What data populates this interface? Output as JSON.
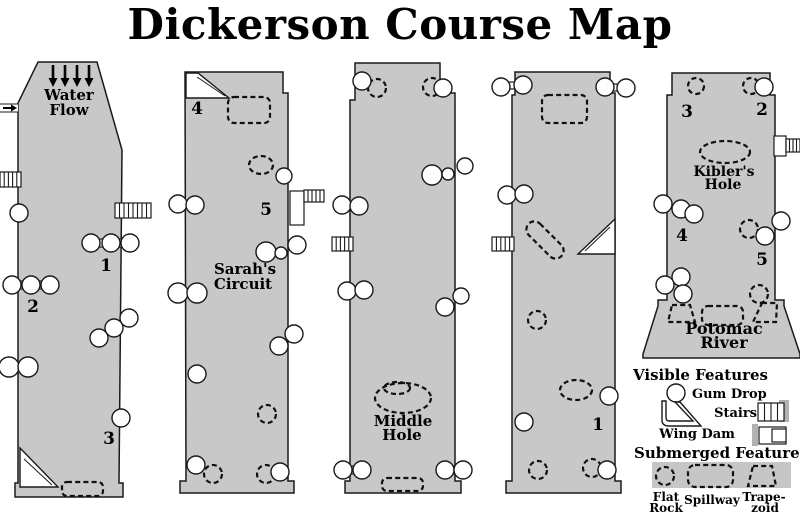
{
  "title": "Dickerson Course Map",
  "colors": {
    "channel_fill": "#c8c8c8",
    "outline": "#1a1a1a",
    "background": "#ffffff",
    "legend_strip": "#c6c6c6",
    "stair_shadow": "#b2b2b2"
  },
  "channels": [
    {
      "id": "channel-1",
      "outline": "38,62 97,62 122,150 119,483 123,483 123,497 15,497 15,483 18,483 18,103",
      "water_flow_arrows": [
        53,
        65,
        77,
        89
      ],
      "inlet": true,
      "gumdrops": [
        [
          19,
          213,
          9
        ],
        [
          91,
          243,
          9
        ],
        [
          111,
          243,
          9
        ],
        [
          130,
          243,
          9
        ],
        [
          12,
          285,
          9
        ],
        [
          31,
          285,
          9
        ],
        [
          50,
          285,
          9
        ],
        [
          9,
          367,
          10
        ],
        [
          28,
          367,
          10
        ],
        [
          129,
          318,
          9
        ],
        [
          114,
          328,
          9
        ],
        [
          99,
          338,
          9
        ],
        [
          121,
          418,
          9
        ]
      ],
      "links": [
        [
          97,
          239,
          8,
          8
        ],
        [
          117,
          239,
          8,
          8
        ],
        [
          19,
          281,
          7,
          8
        ],
        [
          38,
          281,
          7,
          8
        ]
      ],
      "dashed_circles": [],
      "dashed_ellipses": [],
      "dashed_rects": [
        [
          62,
          482,
          41,
          14,
          5,
          0
        ]
      ],
      "dashed_polys": [],
      "wing_dams": [
        {
          "pts": "20,448 58,487 20,487",
          "inner": "24,459 52,485"
        }
      ],
      "stairs": [
        [
          0,
          172,
          21,
          15,
          4
        ],
        [
          115,
          203,
          36,
          15,
          7
        ]
      ],
      "platforms": [],
      "labels": [
        [
          "Water",
          69,
          100,
          15
        ],
        [
          "Flow",
          69,
          115,
          15
        ],
        [
          "1",
          106,
          271,
          17
        ],
        [
          "2",
          33,
          312,
          17
        ],
        [
          "3",
          109,
          444,
          17
        ]
      ]
    },
    {
      "id": "channel-2",
      "outline": "185,72 283,72 283,93 288,93 288,481 294,481 294,493 180,493 180,481 186,481",
      "gumdrops": [
        [
          178,
          204,
          9
        ],
        [
          195,
          205,
          9
        ],
        [
          284,
          176,
          8
        ],
        [
          297,
          245,
          9
        ],
        [
          266,
          252,
          10
        ],
        [
          281,
          253,
          6
        ],
        [
          178,
          293,
          10
        ],
        [
          197,
          293,
          10
        ],
        [
          294,
          334,
          9
        ],
        [
          279,
          346,
          9
        ],
        [
          197,
          374,
          9
        ],
        [
          196,
          465,
          9
        ],
        [
          280,
          472,
          9
        ]
      ],
      "links": [],
      "dashed_circles": [
        [
          267,
          414,
          9
        ],
        [
          213,
          474,
          9
        ],
        [
          266,
          474,
          9
        ]
      ],
      "dashed_ellipses": [
        [
          261,
          165,
          12,
          9,
          0
        ]
      ],
      "dashed_rects": [
        [
          228,
          97,
          42,
          26,
          6,
          0
        ]
      ],
      "dashed_polys": [],
      "wing_dams": [
        {
          "pts": "186,73 198,73 229,98 186,98",
          "inner": "197,77 225,96"
        }
      ],
      "stairs": [
        [
          304,
          190,
          20,
          12,
          4
        ]
      ],
      "platforms": [
        [
          290,
          191,
          14,
          34
        ]
      ],
      "labels": [
        [
          "4",
          197,
          114,
          17
        ],
        [
          "5",
          266,
          215,
          17
        ],
        [
          "Sarah's",
          245,
          274,
          15
        ],
        [
          "Circuit",
          243,
          289,
          15
        ]
      ]
    },
    {
      "id": "channel-3",
      "outline": "355,63 440,63 440,93 455,93 455,481 461,481 461,493 345,493 345,481 350,481 350,100 355,100",
      "gumdrops": [
        [
          362,
          81,
          9
        ],
        [
          443,
          88,
          9
        ],
        [
          342,
          205,
          9
        ],
        [
          359,
          206,
          9
        ],
        [
          432,
          175,
          10
        ],
        [
          448,
          174,
          6
        ],
        [
          465,
          166,
          8
        ],
        [
          347,
          291,
          9
        ],
        [
          364,
          290,
          9
        ],
        [
          445,
          307,
          9
        ],
        [
          461,
          296,
          8
        ],
        [
          343,
          470,
          9
        ],
        [
          362,
          470,
          9
        ],
        [
          445,
          470,
          9
        ],
        [
          463,
          470,
          9
        ]
      ],
      "links": [
        [
          349,
          466,
          7,
          8
        ],
        [
          452,
          466,
          7,
          8
        ]
      ],
      "dashed_circles": [
        [
          377,
          88,
          9
        ],
        [
          432,
          87,
          9
        ]
      ],
      "dashed_ellipses": [
        [
          403,
          398,
          28,
          15,
          0
        ],
        [
          397,
          388,
          13,
          6,
          0
        ]
      ],
      "dashed_rects": [
        [
          382,
          478,
          41,
          13,
          5,
          0
        ]
      ],
      "dashed_polys": [],
      "wing_dams": [],
      "stairs": [
        [
          332,
          237,
          21,
          14,
          4
        ]
      ],
      "platforms": [],
      "labels": [
        [
          "Middle",
          403,
          426,
          15
        ],
        [
          "Hole",
          402,
          440,
          15
        ]
      ]
    },
    {
      "id": "channel-4",
      "outline": "515,72 610,72 610,93 615,93 615,481 621,481 621,493 506,493 506,481 512,481 512,95 515,95",
      "gumdrops": [
        [
          501,
          87,
          9
        ],
        [
          523,
          85,
          9
        ],
        [
          605,
          87,
          9
        ],
        [
          626,
          88,
          9
        ],
        [
          507,
          195,
          9
        ],
        [
          524,
          194,
          9
        ],
        [
          609,
          396,
          9
        ],
        [
          524,
          422,
          9
        ],
        [
          607,
          470,
          9
        ]
      ],
      "links": [
        [
          506,
          82,
          10,
          7
        ],
        [
          611,
          84,
          9,
          7
        ]
      ],
      "dashed_circles": [
        [
          537,
          320,
          9
        ],
        [
          538,
          470,
          9
        ],
        [
          592,
          468,
          9
        ]
      ],
      "dashed_ellipses": [
        [
          576,
          390,
          16,
          10,
          0
        ]
      ],
      "dashed_rects": [
        [
          542,
          95,
          45,
          28,
          6,
          0
        ],
        [
          522,
          232,
          46,
          16,
          8,
          45
        ]
      ],
      "dashed_polys": [],
      "wing_dams": [
        {
          "pts": "615,219 615,254 578,254",
          "inner": "610,227 585,251"
        }
      ],
      "stairs": [
        [
          492,
          237,
          22,
          14,
          4
        ]
      ],
      "platforms": [],
      "labels": [
        [
          "1",
          598,
          430,
          17
        ]
      ]
    },
    {
      "id": "channel-5",
      "outline": "672,73 770,73 770,95 775,95 775,300 784,300 784,306 800,354 800,358 643,358 643,354 658,306 658,300 667,300 667,95 672,95",
      "gumdrops": [
        [
          764,
          87,
          9
        ],
        [
          663,
          204,
          9
        ],
        [
          681,
          209,
          9
        ],
        [
          694,
          214,
          9
        ],
        [
          781,
          221,
          9
        ],
        [
          765,
          236,
          9
        ],
        [
          681,
          277,
          9
        ],
        [
          665,
          285,
          9
        ],
        [
          683,
          294,
          9
        ]
      ],
      "links": [],
      "dashed_circles": [
        [
          696,
          86,
          8
        ],
        [
          751,
          86,
          8
        ],
        [
          749,
          229,
          9
        ],
        [
          759,
          294,
          9
        ]
      ],
      "dashed_ellipses": [
        [
          725,
          152,
          25,
          11,
          0
        ]
      ],
      "dashed_rects": [
        [
          702,
          306,
          41,
          19,
          6,
          0
        ]
      ],
      "dashed_polys": [
        "672,305 690,305 695,322 668,322",
        "762,303 777,303 776,322 753,322"
      ],
      "wing_dams": [],
      "stairs": [
        [
          786,
          139,
          14,
          13,
          3
        ]
      ],
      "platforms": [
        [
          774,
          136,
          12,
          20
        ]
      ],
      "labels": [
        [
          "3",
          687,
          117,
          17
        ],
        [
          "2",
          762,
          115,
          17
        ],
        [
          "Kibler's",
          724,
          176,
          14
        ],
        [
          "Hole",
          723,
          189,
          14
        ],
        [
          "4",
          682,
          241,
          17
        ],
        [
          "5",
          762,
          265,
          17
        ],
        [
          "Potomac",
          724,
          334,
          16
        ],
        [
          "River",
          724,
          348,
          16
        ]
      ]
    }
  ],
  "legend": {
    "visible_heading": "Visible Features",
    "submerged_heading": "Submerged Features",
    "items": {
      "gum_drop": "Gum Drop",
      "stairs": "Stairs",
      "wing_dam": "Wing Dam",
      "flat_rock": [
        "Flat",
        "Rock"
      ],
      "spillway": "Spillway",
      "trapezoid": [
        "Trape-",
        "zoid"
      ]
    }
  }
}
